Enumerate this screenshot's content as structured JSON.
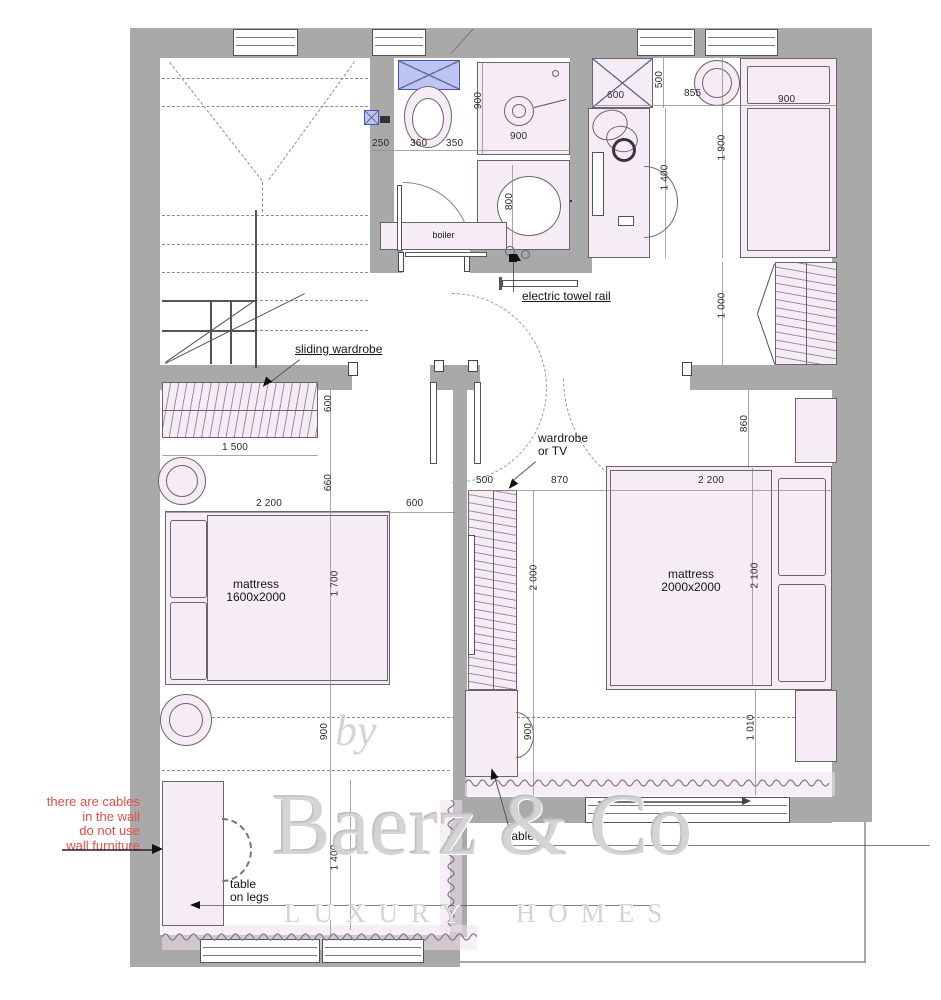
{
  "colors": {
    "wall": "#a9a9a9",
    "furniture_fill": "#f6ecf6",
    "cistern_blue": "#bcc4f2",
    "note_red": "#e34f46",
    "watermark_gray": "#cbcbcb"
  },
  "labels": {
    "sliding_wardrobe": "sliding wardrobe",
    "electric_towel_rail": "electric towel rail",
    "wardrobe_or_tv_line1": "wardrobe",
    "wardrobe_or_tv_line2": "or TV",
    "bed_left_line1": "mattress",
    "bed_left_line2": "1600x2000",
    "bed_right_line1": "mattress",
    "bed_right_line2": "2000x2000",
    "table_on_legs_line1": "table",
    "table_on_legs_line2": "on legs",
    "table": "table",
    "boiler": "boiler"
  },
  "note": {
    "lines": [
      "there are cables",
      "in the wall",
      "do not use",
      "wall furniture"
    ]
  },
  "watermark": {
    "by": "by",
    "name": "Baerz & Co",
    "tagline": "LUXURY HOMES"
  },
  "dimensions": [
    {
      "text": "250",
      "x": 372,
      "y": 138,
      "v": 0
    },
    {
      "text": "360",
      "x": 410,
      "y": 138,
      "v": 0
    },
    {
      "text": "350",
      "x": 446,
      "y": 138,
      "v": 0
    },
    {
      "text": "900",
      "x": 470,
      "y": 95,
      "v": 1
    },
    {
      "text": "900",
      "x": 510,
      "y": 131,
      "v": 0
    },
    {
      "text": "800",
      "x": 501,
      "y": 196,
      "v": 1
    },
    {
      "text": "600",
      "x": 607,
      "y": 90,
      "v": 0
    },
    {
      "text": "500",
      "x": 651,
      "y": 74,
      "v": 1
    },
    {
      "text": "855",
      "x": 684,
      "y": 88,
      "v": 0
    },
    {
      "text": "1 400",
      "x": 652,
      "y": 172,
      "v": 1
    },
    {
      "text": "1 900",
      "x": 709,
      "y": 142,
      "v": 1
    },
    {
      "text": "900",
      "x": 778,
      "y": 94,
      "v": 0
    },
    {
      "text": "1 000",
      "x": 709,
      "y": 300,
      "v": 1
    },
    {
      "text": "600",
      "x": 320,
      "y": 398,
      "v": 1
    },
    {
      "text": "1 500",
      "x": 222,
      "y": 442,
      "v": 0
    },
    {
      "text": "660",
      "x": 320,
      "y": 477,
      "v": 1
    },
    {
      "text": "2 200",
      "x": 256,
      "y": 498,
      "v": 0
    },
    {
      "text": "600",
      "x": 406,
      "y": 498,
      "v": 0
    },
    {
      "text": "1 700",
      "x": 322,
      "y": 578,
      "v": 1
    },
    {
      "text": "900",
      "x": 316,
      "y": 726,
      "v": 1
    },
    {
      "text": "500",
      "x": 476,
      "y": 475,
      "v": 0
    },
    {
      "text": "870",
      "x": 551,
      "y": 475,
      "v": 0
    },
    {
      "text": "2 000",
      "x": 521,
      "y": 572,
      "v": 1
    },
    {
      "text": "900",
      "x": 520,
      "y": 726,
      "v": 1
    },
    {
      "text": "2 200",
      "x": 698,
      "y": 475,
      "v": 0
    },
    {
      "text": "860",
      "x": 736,
      "y": 418,
      "v": 1
    },
    {
      "text": "2 100",
      "x": 742,
      "y": 570,
      "v": 1
    },
    {
      "text": "1 010",
      "x": 738,
      "y": 722,
      "v": 1
    },
    {
      "text": "1 400",
      "x": 322,
      "y": 852,
      "v": 1
    }
  ]
}
